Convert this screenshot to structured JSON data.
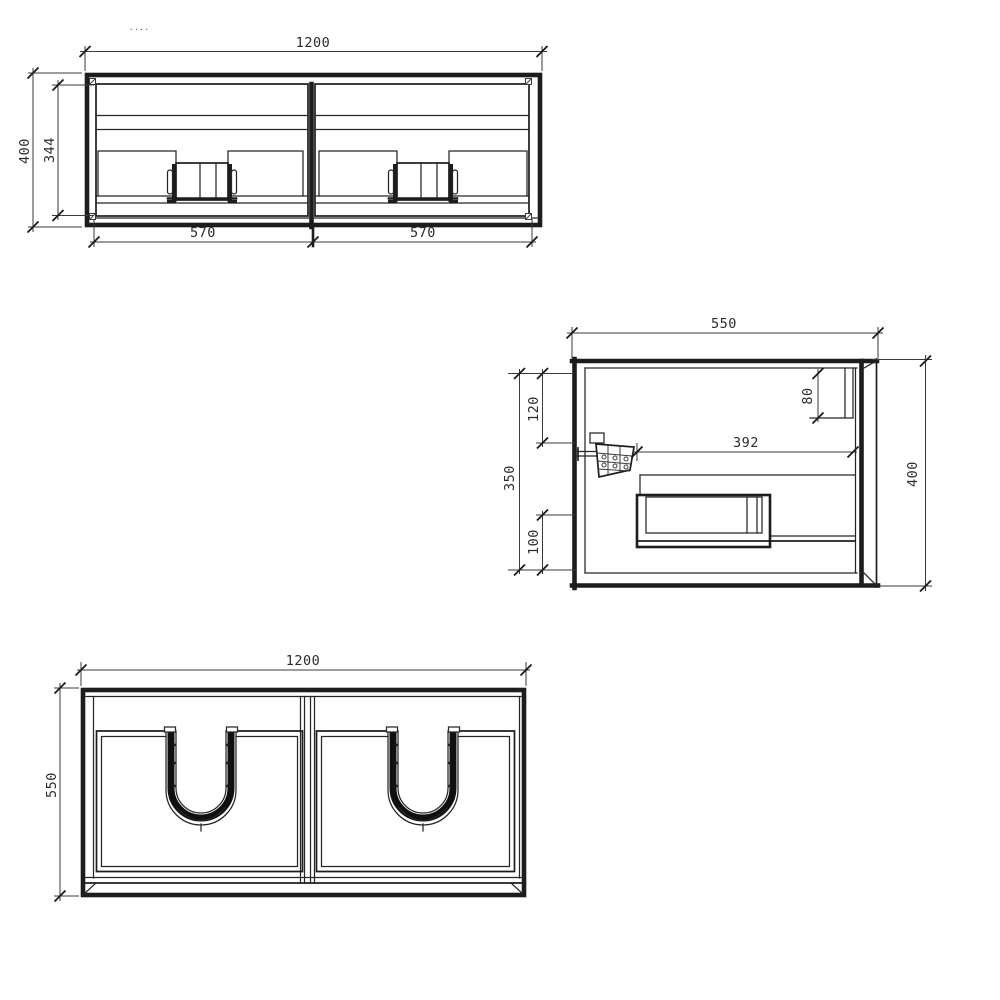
{
  "drawing": {
    "artifact_mark": "····",
    "front_view": {
      "width": "1200",
      "height": "400",
      "inner_height": "344",
      "left_door_width": "570",
      "right_door_width": "570"
    },
    "side_view": {
      "depth": "550",
      "height": "400",
      "interior_height": "350",
      "top_offset": "120",
      "bottom_offset": "100",
      "drawer_inner_depth": "392",
      "top_rail_height": "80"
    },
    "plan_view": {
      "width": "1200",
      "depth": "550"
    },
    "line_color": "#1d1d1d",
    "background_color": "#ffffff"
  }
}
